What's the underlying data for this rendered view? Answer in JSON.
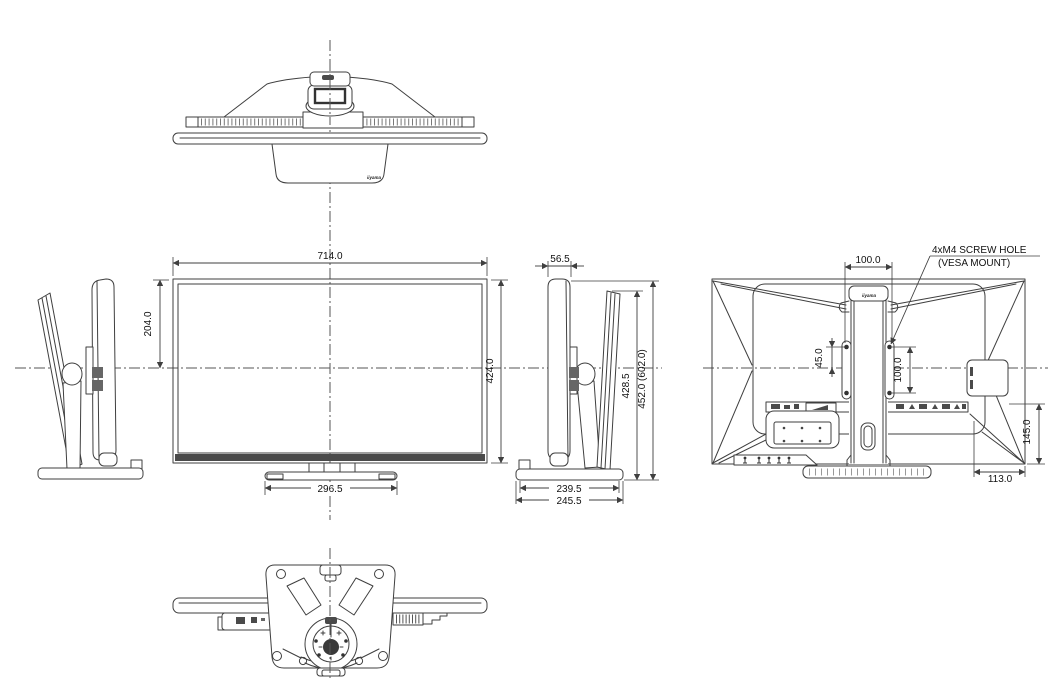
{
  "drawing": {
    "brand": "iiyama",
    "annotation": {
      "line1": "4xM4 SCREW HOLE",
      "line2": "(VESA MOUNT)"
    },
    "dimensions": {
      "front_width": "714.0",
      "front_upper_height": "204.0",
      "front_height": "424.0",
      "front_base_width": "296.5",
      "side_depth": "56.5",
      "side_height_tilted": "428.5",
      "side_height_total": "452.0 (602.0)",
      "side_base_depth": "239.5",
      "side_base_depth_outer": "245.5",
      "vesa_hole_spacing_x": "100.0",
      "vesa_hole_offset": "45.0",
      "vesa_hole_spacing_y": "100.0",
      "rear_connector_height": "145.0",
      "rear_connector_offset": "113.0"
    },
    "colors": {
      "line": "#3f3f3f",
      "dark_fill": "#4a4a4a",
      "background": "#ffffff"
    }
  }
}
